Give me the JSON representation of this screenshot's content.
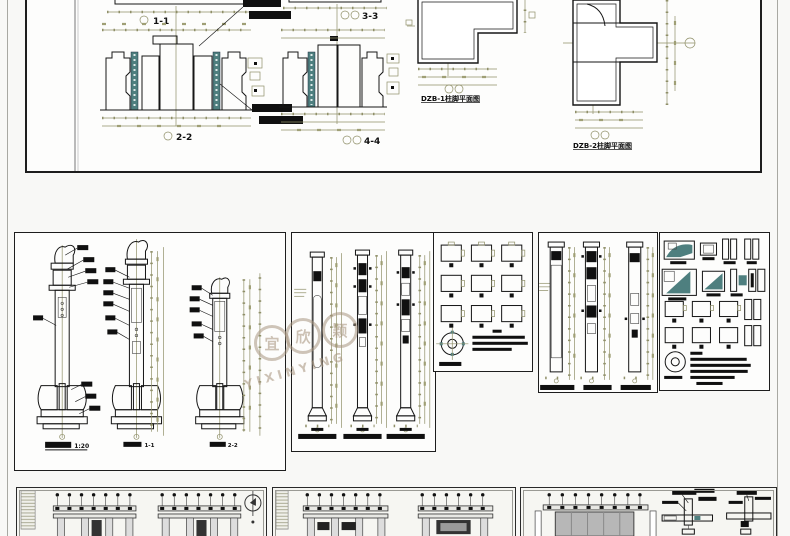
{
  "document": {
    "kind": "cad-multi-sheet-drawing-preview"
  },
  "colors": {
    "background": "#f8f8f6",
    "sheet": "#fdfdfc",
    "ink": "#161616",
    "dimension": "#8f8f68",
    "teal_hatch": "#5d8a8a",
    "teal_fill": "#4e7f7f",
    "hatch_bg": "#e2ebea",
    "cyan_fill": "#cfe3e3",
    "gray_mass": "#b7b7b7",
    "watermark": "#a89680"
  },
  "top_sheet": {
    "section_labels": [
      {
        "id": "s11",
        "label": "1-1"
      },
      {
        "id": "s22",
        "label": "2-2"
      },
      {
        "id": "s33",
        "label": "3-3"
      },
      {
        "id": "s44",
        "label": "4-4"
      }
    ],
    "plan_labels": [
      {
        "id": "dzb1",
        "label": "DZB-1柱脚平面图"
      },
      {
        "id": "dzb2",
        "label": "DZB-2柱脚平面图"
      }
    ]
  },
  "middle": {
    "scale": "1:20",
    "elevation_labels": [
      "1-1",
      "2-2"
    ]
  },
  "watermark": {
    "characters": [
      "宜",
      "欣",
      "颖"
    ],
    "latin": "YIXINYING"
  }
}
